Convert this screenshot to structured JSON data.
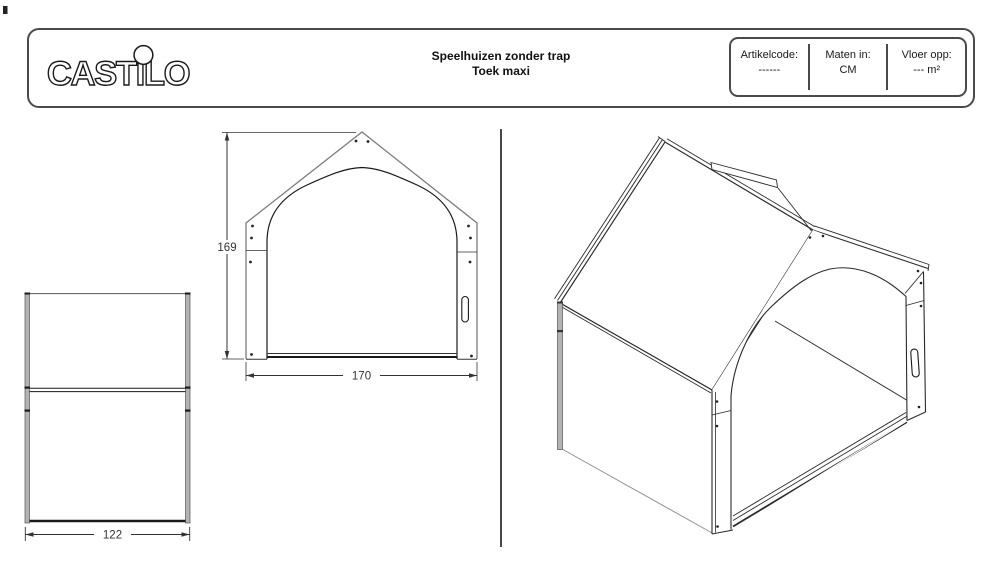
{
  "header": {
    "logo": "CASTILO",
    "title_line1": "Speelhuizen zonder trap",
    "title_line2": "Toek maxi",
    "info_box": {
      "columns": [
        {
          "label": "Artikelcode:",
          "value": "------"
        },
        {
          "label": "Maten in:",
          "value": "CM"
        },
        {
          "label": "Vloer opp:",
          "value": "--- m²"
        }
      ]
    }
  },
  "drawing": {
    "dimensions": {
      "side_width_cm": "122",
      "front_height_cm": "169",
      "front_width_cm": "170"
    }
  },
  "colors": {
    "line_dark": "#1a1a1a",
    "line_gray": "#7d7d7d",
    "panel_edge_fill": "#b3b3b3",
    "border": "#4a4a4a"
  }
}
